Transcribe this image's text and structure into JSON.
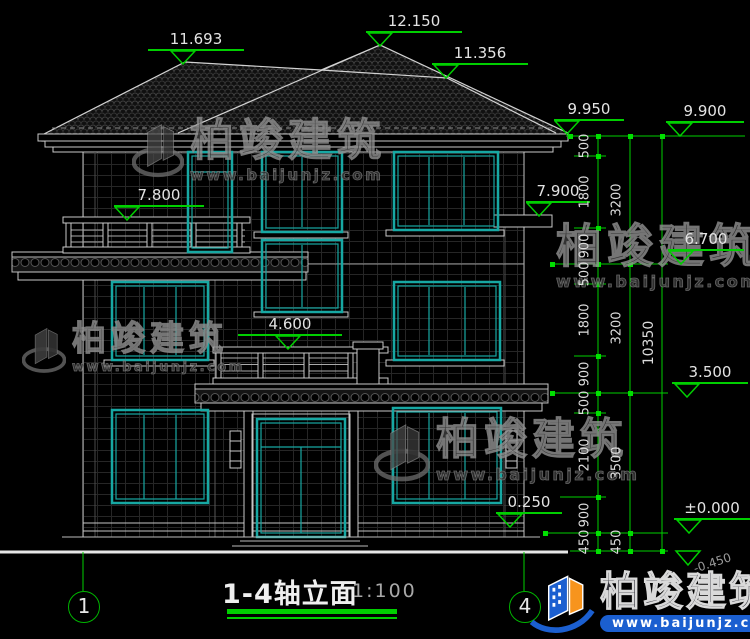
{
  "drawing": {
    "title": "1-4轴立面",
    "scale": "1:100",
    "axes": [
      {
        "label": "1"
      },
      {
        "label": "4"
      }
    ],
    "elevations": [
      {
        "value": "11.693"
      },
      {
        "value": "12.150"
      },
      {
        "value": "11.356"
      },
      {
        "value": "9.950"
      },
      {
        "value": "9.900"
      },
      {
        "value": "7.800"
      },
      {
        "value": "7.900"
      },
      {
        "value": "6.700"
      },
      {
        "value": "4.600"
      },
      {
        "value": "3.500"
      },
      {
        "value": "0.250"
      },
      {
        "value": "±0.000"
      },
      {
        "value": "-0.450"
      }
    ],
    "dim_chain_inner": [
      "500",
      "1800",
      "900",
      "500",
      "1800",
      "900",
      "500",
      "2100",
      "900",
      "450"
    ],
    "dim_chain_middle": [
      "3200",
      "3200",
      "3500",
      "450"
    ],
    "dim_chain_outer": [
      "10350"
    ]
  },
  "watermark": {
    "brand": "柏竣建筑",
    "url": "www.baijunjz.com"
  },
  "footer_logo": {
    "brand": "柏竣建筑",
    "url": "www.baijunjz.com"
  },
  "colors": {
    "dimension_green": "#00cf00",
    "window_teal": "#17a8a3",
    "line_white": "#c9c9c9",
    "background": "#000000",
    "logo_blue": "#1b5fd0",
    "logo_orange": "#f7941d"
  }
}
